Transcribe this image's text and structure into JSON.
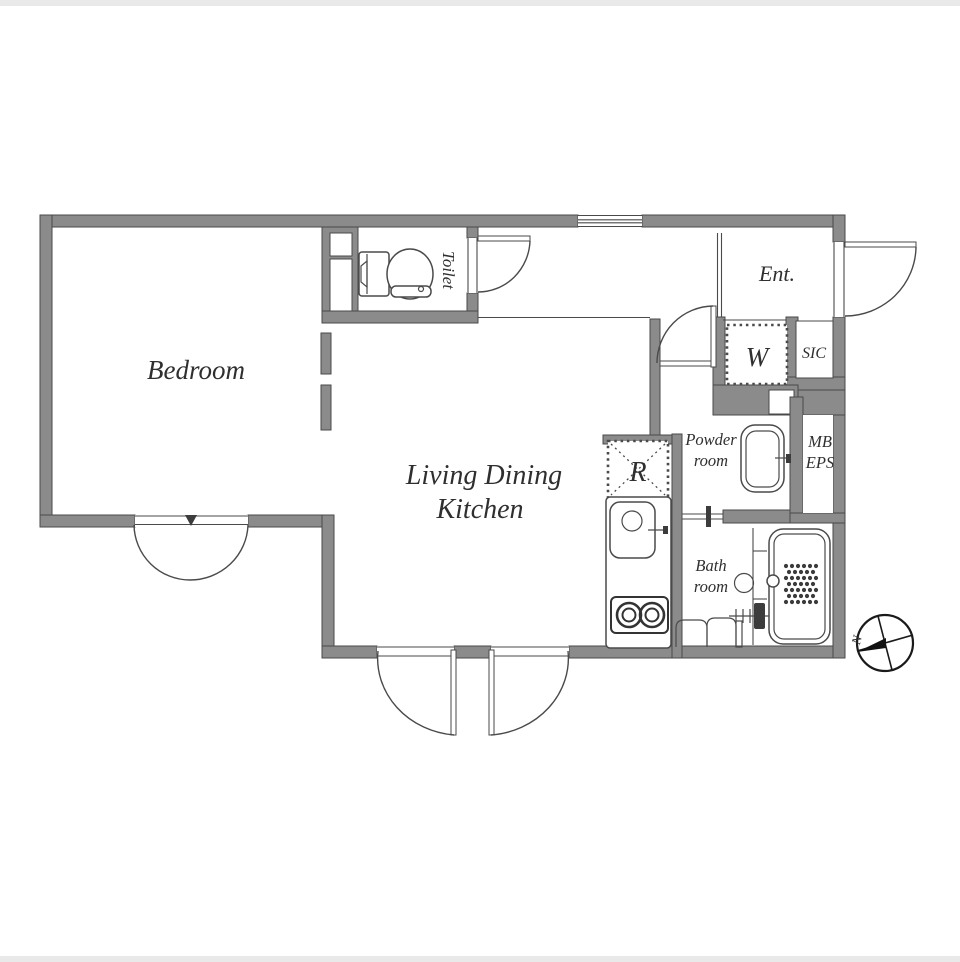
{
  "plan": {
    "colors": {
      "wall_fill": "#8b8b8b",
      "wall_edge": "#4a4a4a",
      "line": "#4a4a4a",
      "text": "#2f2f2f",
      "background": "#ffffff"
    },
    "rooms": {
      "bedroom": {
        "label": "Bedroom"
      },
      "living_dining_kitchen": {
        "label_line1": "Living Dining",
        "label_line2": "Kitchen"
      },
      "toilet": {
        "label": "Toilet"
      },
      "entrance": {
        "label": "Ent."
      },
      "washer_space": {
        "label": "W"
      },
      "shoe_closet": {
        "label": "SIC"
      },
      "powder_room": {
        "label_line1": "Powder",
        "label_line2": "room"
      },
      "meter_box": {
        "label_line1": "MB",
        "label_line2": "EPS"
      },
      "refrigerator_space": {
        "label": "R"
      },
      "bathroom": {
        "label_line1": "Bath",
        "label_line2": "room"
      }
    },
    "compass": {
      "north_label": "N"
    }
  }
}
